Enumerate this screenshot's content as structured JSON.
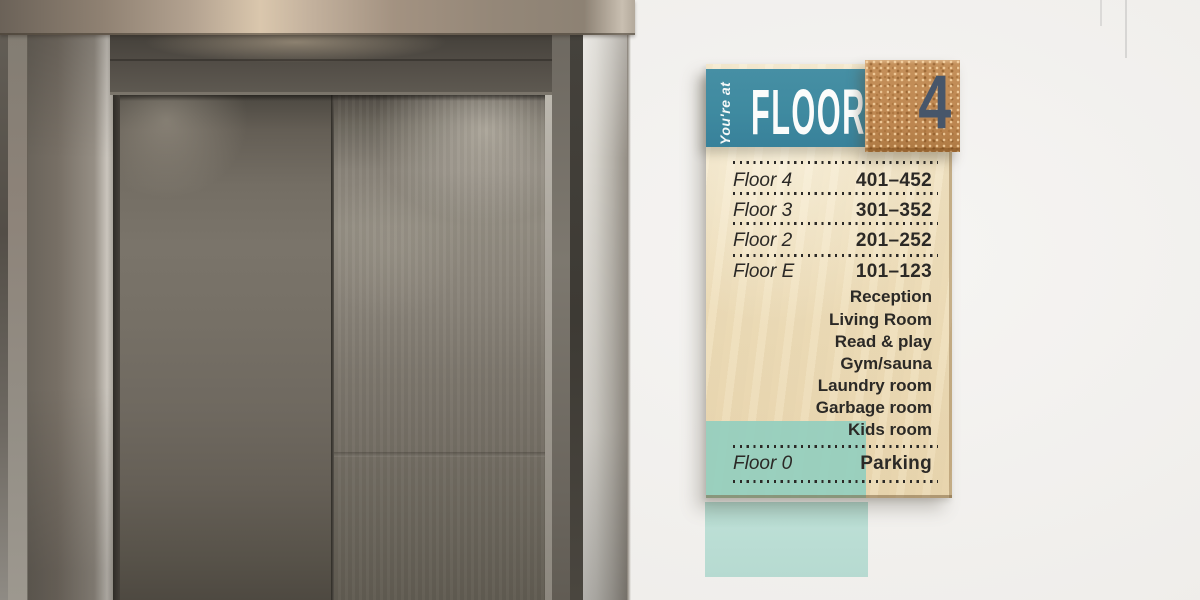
{
  "scene": {
    "subject": "elevator-lobby",
    "left": "stainless-steel-elevator-doors",
    "right": "wooden-floor-directory-sign-on-wall"
  },
  "sign": {
    "header": {
      "prefix": "You're at",
      "title": "FLOOR",
      "number": "4"
    },
    "directory": {
      "rows": [
        {
          "label": "Floor 4",
          "value": "401–452"
        },
        {
          "label": "Floor 3",
          "value": "301–352"
        },
        {
          "label": "Floor 2",
          "value": "201–252"
        },
        {
          "label": "Floor E",
          "value": "101–123"
        },
        {
          "label": "Floor 0",
          "value": "Parking"
        }
      ],
      "floor_e_amenities": [
        "Reception",
        "Living Room",
        "Read & play",
        "Gym/sauna",
        "Laundry room",
        "Garbage room",
        "Kids room"
      ]
    },
    "colors": {
      "teal": "#3f8aa0",
      "mint": "#93cfbe",
      "mint_wall": "#b7ddd3",
      "cork": "#bf8a52",
      "numeral": "#47566a",
      "ink": "#2b2926"
    }
  }
}
